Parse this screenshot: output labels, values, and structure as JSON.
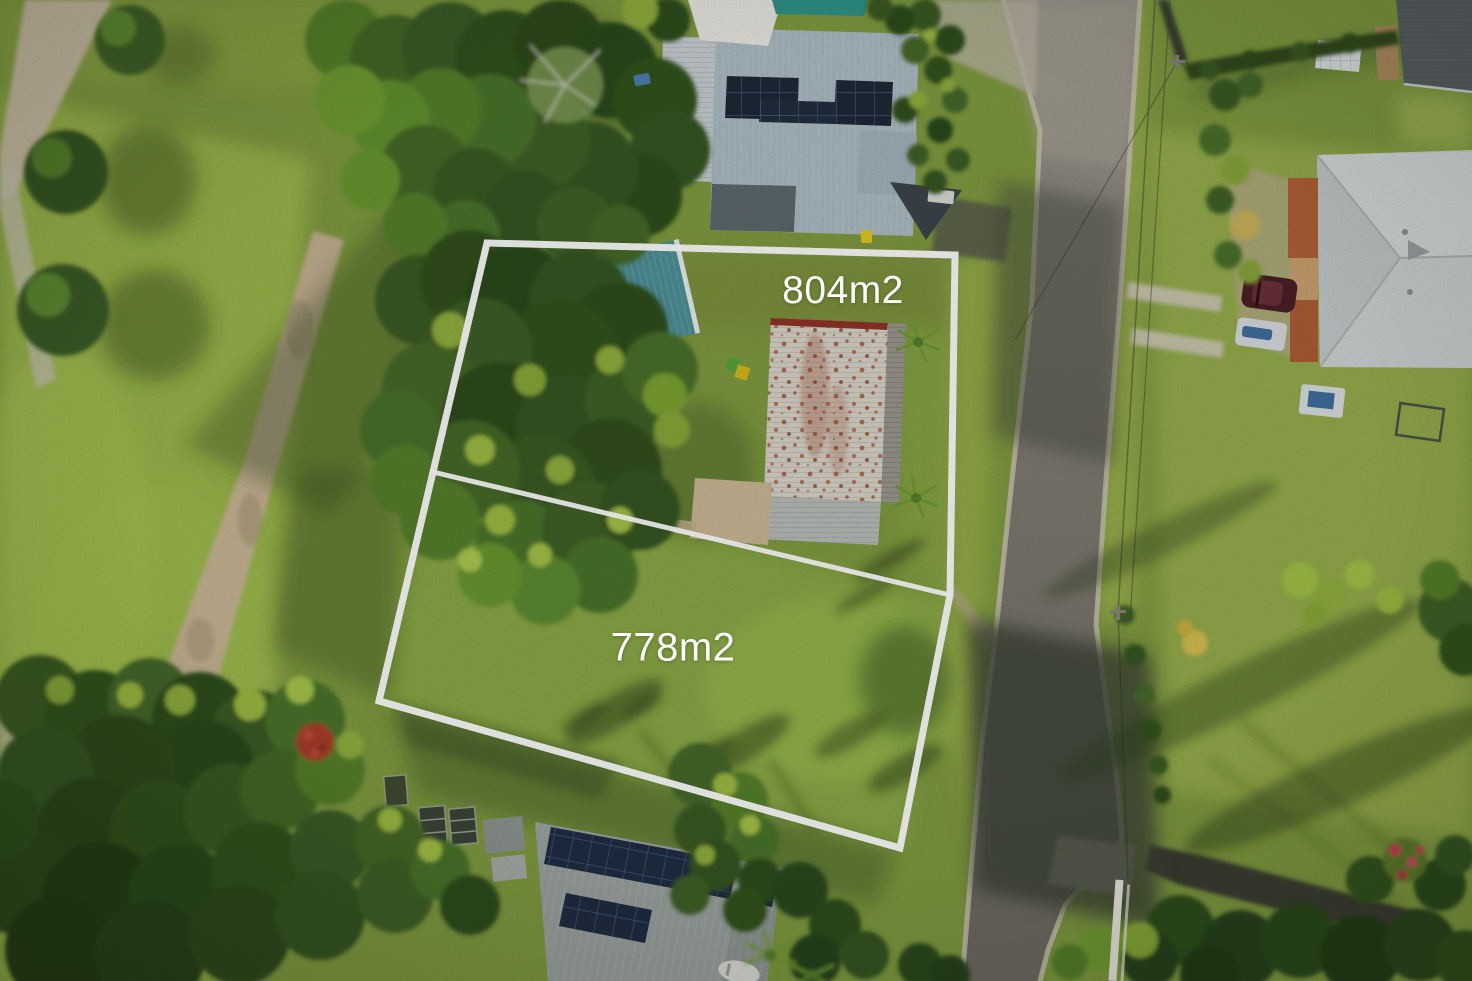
{
  "photo": {
    "lots": [
      {
        "id": "lot-804",
        "label": "804m2",
        "area_m2": 804
      },
      {
        "id": "lot-778",
        "label": "778m2",
        "area_m2": 778
      }
    ],
    "boundary_color": "#ffffff",
    "label_text_color": "#ffffff"
  }
}
